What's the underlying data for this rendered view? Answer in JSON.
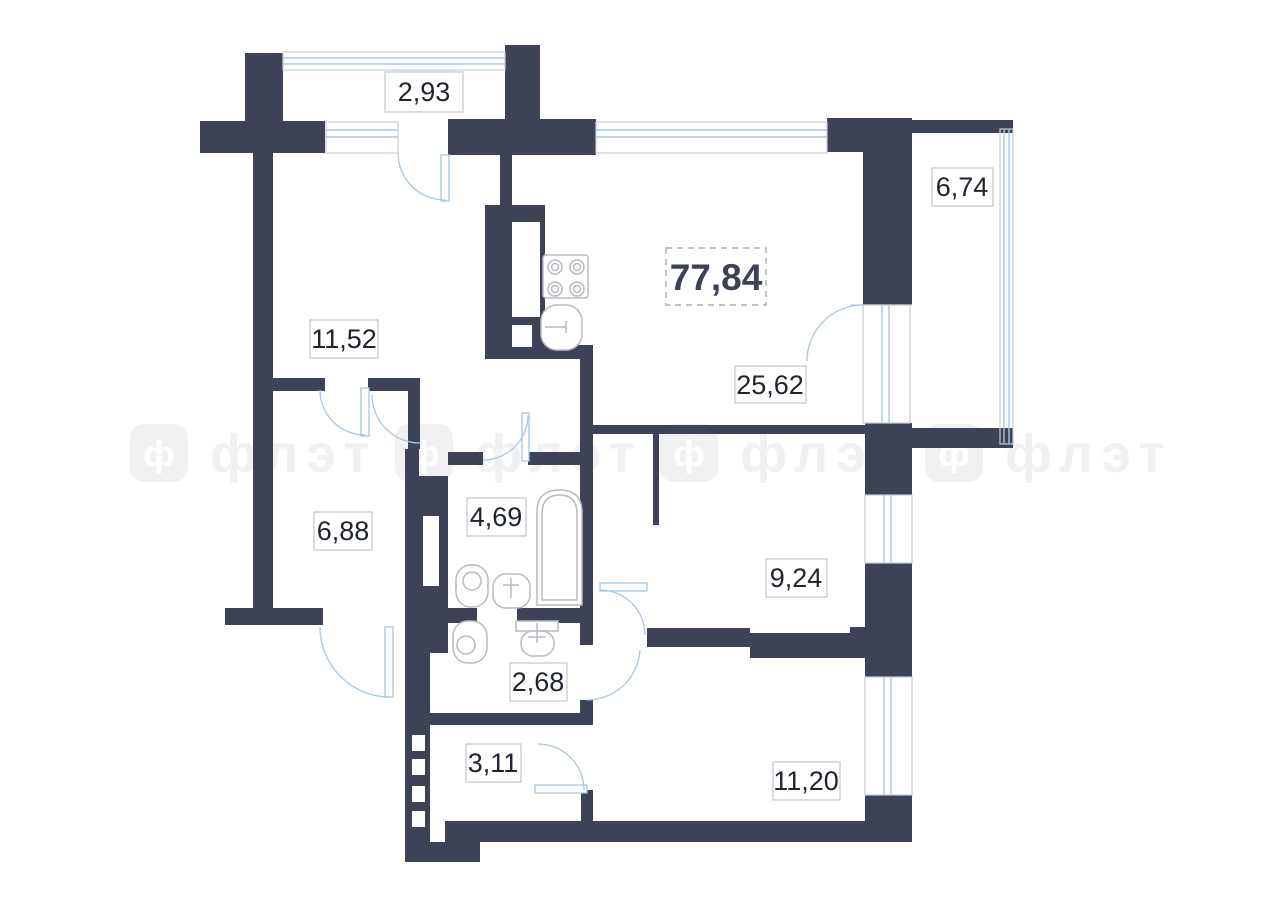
{
  "plan": {
    "title": "apartment-floor-plan",
    "total_area_label": "77,84",
    "rooms": [
      {
        "name": "balcony-top",
        "area_label": "2,93"
      },
      {
        "name": "room-top-left",
        "area_label": "11,52"
      },
      {
        "name": "balcony-right",
        "area_label": "6,74"
      },
      {
        "name": "living-kitchen",
        "area_label": "25,62"
      },
      {
        "name": "hall-left",
        "area_label": "6,88"
      },
      {
        "name": "bathroom",
        "area_label": "4,69"
      },
      {
        "name": "bedroom-right",
        "area_label": "9,24"
      },
      {
        "name": "wc",
        "area_label": "2,68"
      },
      {
        "name": "storage",
        "area_label": "3,11"
      },
      {
        "name": "bedroom-bottom",
        "area_label": "11,20"
      }
    ],
    "watermark": {
      "text": "флэт",
      "logo_letter": "ф"
    },
    "colors": {
      "wall": "#3d4257",
      "window_line": "#a8c7e3",
      "outline_gray": "#c9cdd5",
      "fixture": "#b6bac4",
      "label_border": "#c0c4cc",
      "label_text": "#1e2330",
      "total_border": "#a6acb8",
      "watermark": "#f1f1f4",
      "background": "#ffffff"
    }
  }
}
